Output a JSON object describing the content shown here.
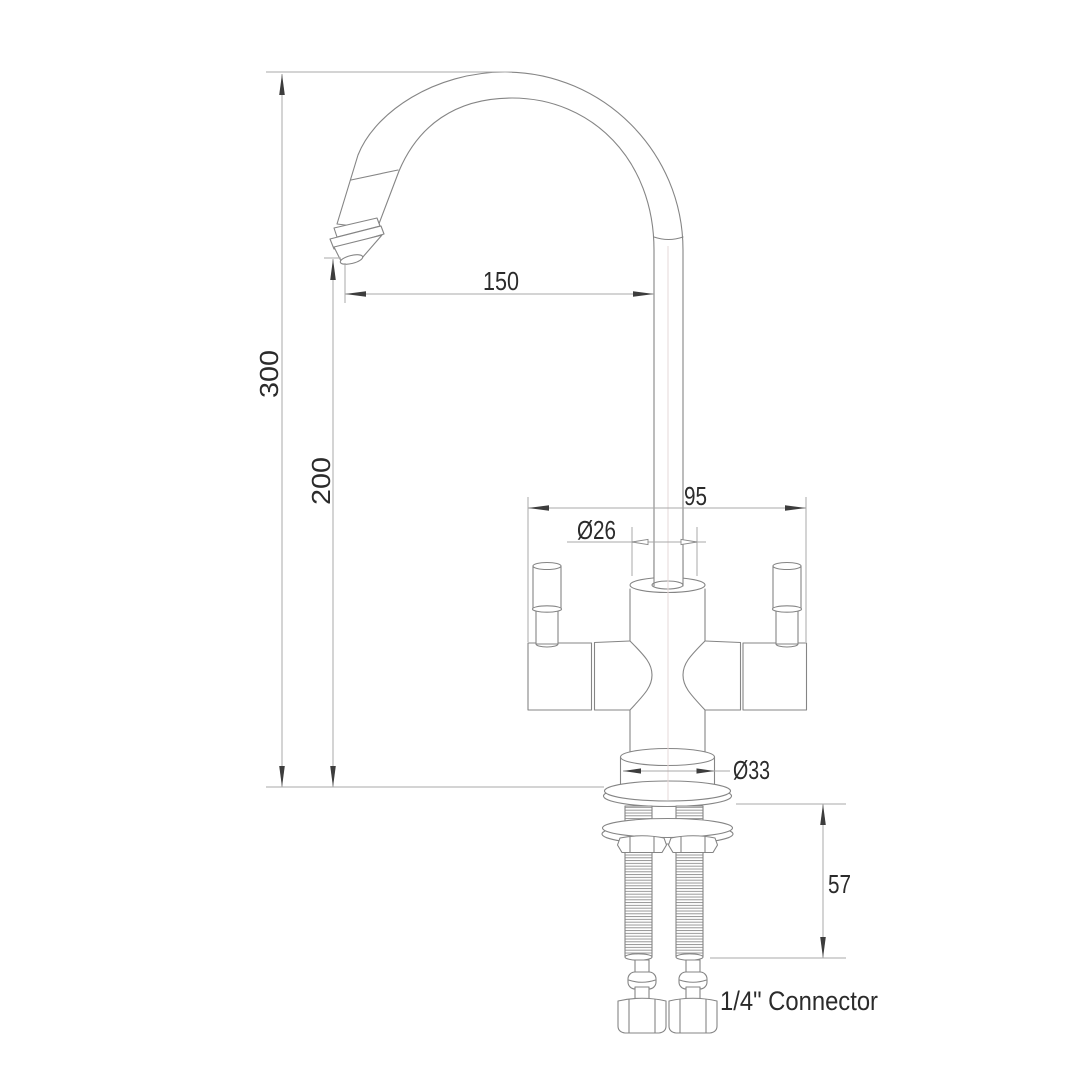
{
  "drawing": {
    "type_label": "faucet-technical-drawing",
    "connector_label": "1/4\" Connector",
    "dimensions": {
      "overall_height": "300",
      "spout_height": "200",
      "spout_reach": "150",
      "handle_span": "95",
      "body_diameter": "Ø26",
      "base_diameter": "Ø33",
      "shank_length": "57"
    },
    "colors": {
      "background": "#ffffff",
      "object_line": "#858585",
      "dimension_line": "#a9a9a9",
      "arrow": "#3d3d3d",
      "text": "#2b2b2b",
      "centerline": "#e6d8d8"
    }
  }
}
